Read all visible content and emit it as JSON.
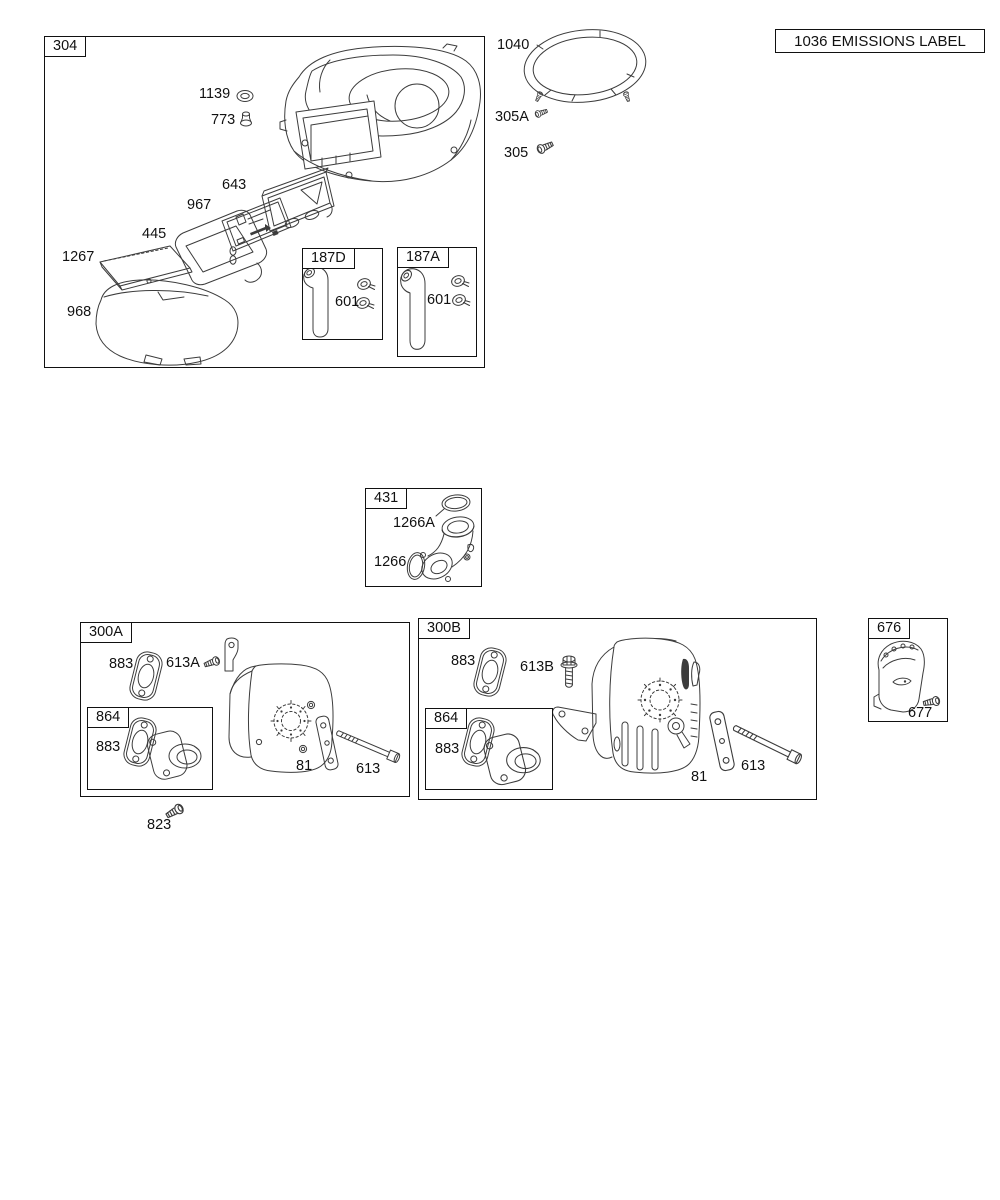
{
  "colors": {
    "background": "#ffffff",
    "line": "#3c3c3c",
    "border": "#111111",
    "text": "#111111"
  },
  "emissions_callout": {
    "text": "1036 EMISSIONS LABEL"
  },
  "group_304": {
    "label": "304",
    "parts": {
      "grommet": "1139",
      "knob": "773",
      "backplate": "643",
      "filter_cartridge": "967",
      "filter_frame": "445",
      "precleaner": "1267",
      "cover_base": "968"
    },
    "sub_187D": {
      "label": "187D",
      "clamp": "601"
    },
    "sub_187A": {
      "label": "187A",
      "clamp": "601"
    }
  },
  "loose_parts": {
    "screen_ring": "1040",
    "screw_305A": "305A",
    "screw_305": "305",
    "screw_823": "823"
  },
  "group_431": {
    "label": "431",
    "o_ring_upper": "1266A",
    "o_ring_lower": "1266"
  },
  "group_300A": {
    "label": "300A",
    "gasket": "883",
    "screw": "613A",
    "plate": "81",
    "bolt": "613",
    "sub_864": {
      "label": "864",
      "gasket": "883"
    }
  },
  "group_300B": {
    "label": "300B",
    "gasket": "883",
    "screw": "613B",
    "plate": "81",
    "bolt": "613",
    "sub_864": {
      "label": "864",
      "gasket": "883"
    }
  },
  "group_676": {
    "label": "676",
    "screw": "677"
  }
}
